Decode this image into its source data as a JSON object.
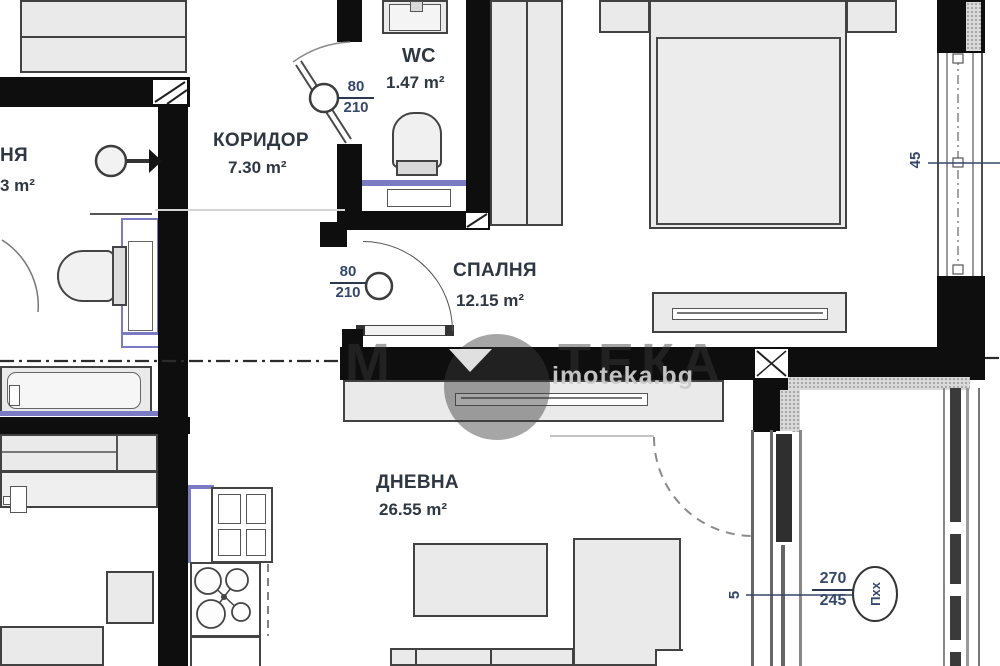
{
  "watermark": {
    "brand_prefix": "М",
    "brand_suffix": "ТЕКА",
    "domain": "imoteka.bg"
  },
  "rooms": {
    "left_partial": {
      "name": "НЯ",
      "area": "3 m²"
    },
    "corridor": {
      "name": "КОРИДОР",
      "area": "7.30 m²"
    },
    "wc": {
      "name": "WC",
      "area": "1.47 m²"
    },
    "bedroom": {
      "name": "СПАЛНЯ",
      "area": "12.15 m²"
    },
    "living": {
      "name": "ДНЕВНА",
      "area": "26.55 m²"
    }
  },
  "dimensions": {
    "wc_door": {
      "width": "80",
      "height": "210"
    },
    "bedroom_door": {
      "width": "80",
      "height": "210"
    },
    "bedroom_window_width": "45",
    "balcony_door": {
      "offset": "5",
      "width": "270",
      "height": "245",
      "tag": "Пхх"
    }
  },
  "colors": {
    "wall": "#0e0e0e",
    "furniture_fill": "#eaeaea",
    "furniture_border": "#424242",
    "accent_blue": "#7b7bc4",
    "dimension_text": "#35476b",
    "label_text": "#2e3742",
    "watermark_light": "#cccccc"
  }
}
